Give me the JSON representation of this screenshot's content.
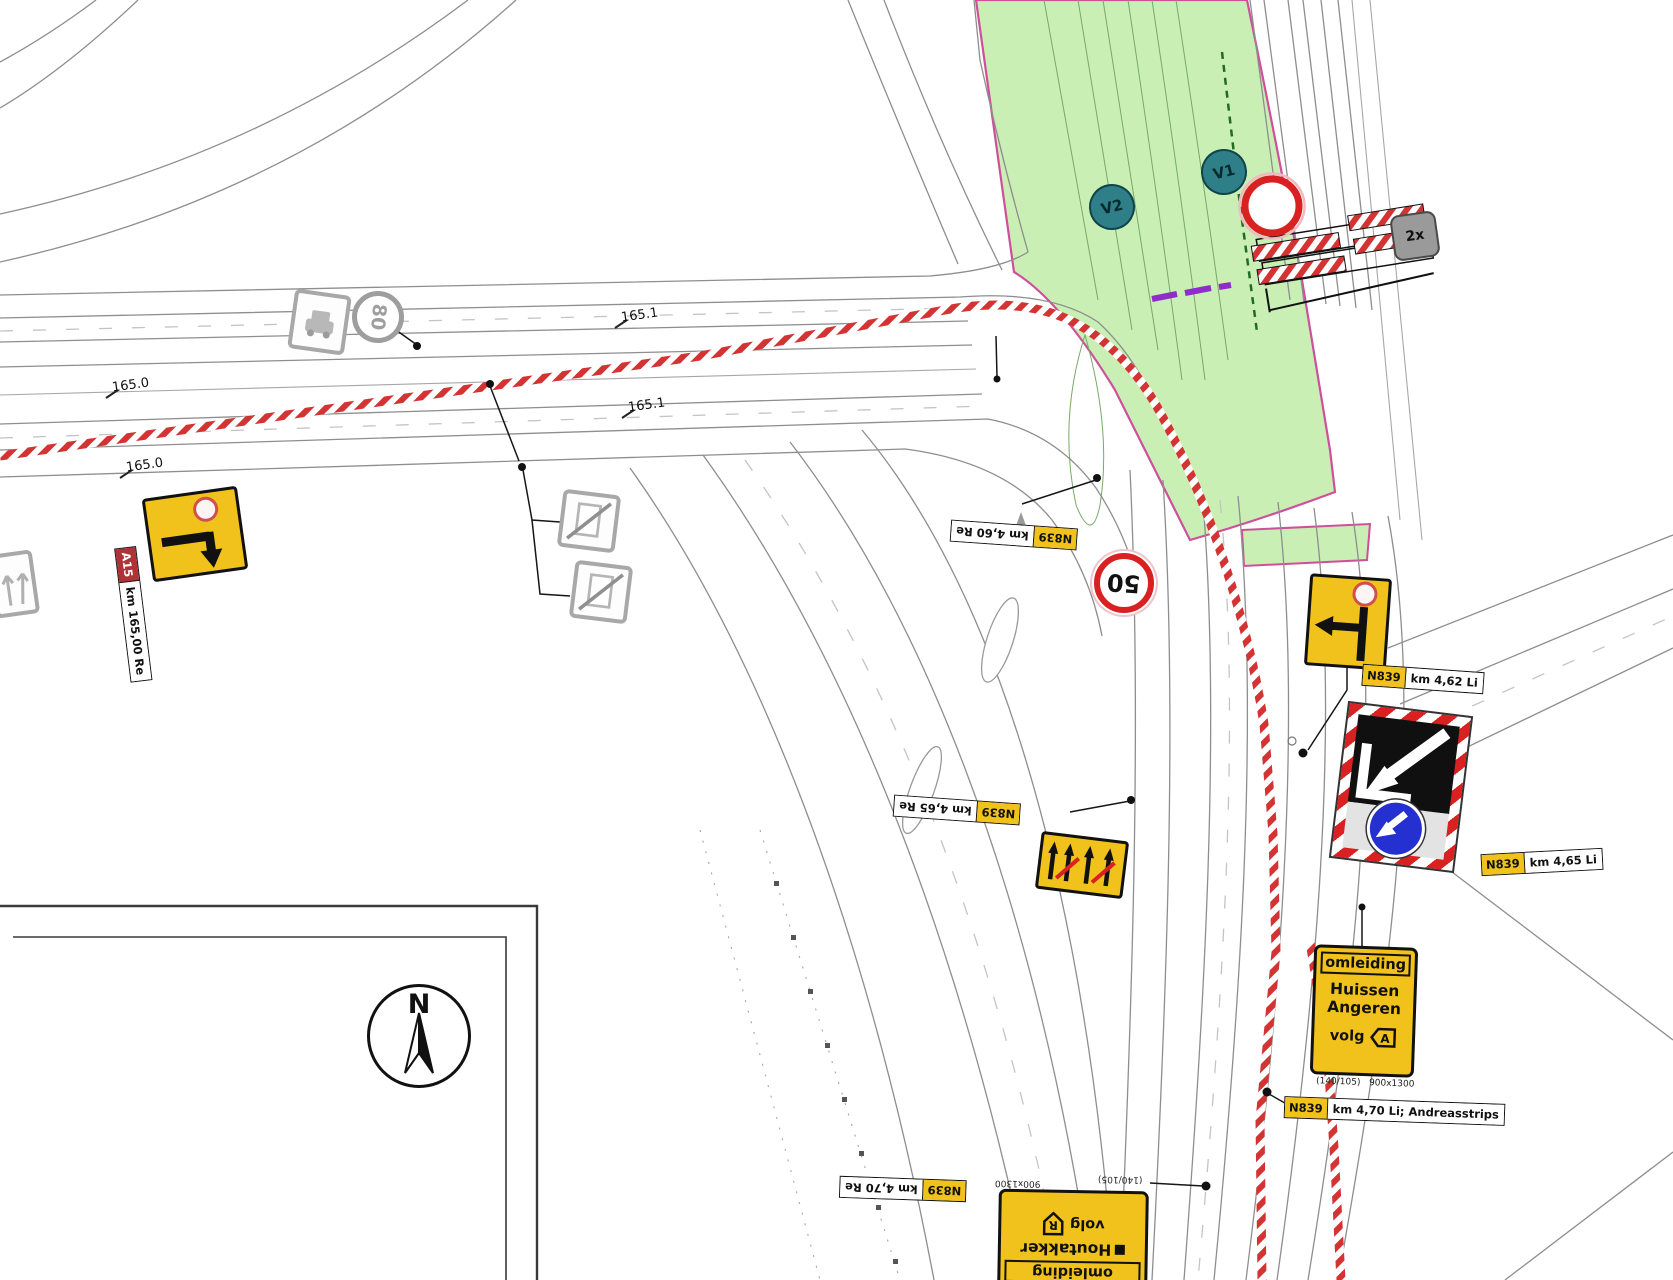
{
  "colors": {
    "work_zone_green": "#c9efb5",
    "zone_border": "#cf4f9b",
    "sign_yellow": "#f2c21c",
    "barrier_red": "#d92121",
    "detour_blue": "#2430cf",
    "purple_marker": "#8e2ccc"
  },
  "compass": {
    "letter": "N"
  },
  "barrier_tag": {
    "count": "2x"
  },
  "speed_signs": {
    "existing_80": "80",
    "temporary_50": "50"
  },
  "phase_badges": {
    "v1": "V1",
    "v2": "V2"
  },
  "km_markers": [
    "165.0",
    "165.0",
    "165.1",
    "165.1"
  ],
  "chips": {
    "a15": {
      "road": "A15",
      "km": "km 165,00 Re"
    },
    "n839_460re": {
      "road": "N839",
      "km": "km 4,60 Re"
    },
    "n839_462li": {
      "road": "N839",
      "km": "km 4,62 Li"
    },
    "n839_465li": {
      "road": "N839",
      "km": "km 4,65 Li"
    },
    "n839_465re": {
      "road": "N839",
      "km": "km 4,65 Re"
    },
    "n839_470re": {
      "road": "N839",
      "km": "km 4,70 Re"
    },
    "n839_470li": {
      "road": "N839",
      "km": "km 4,70 Li; Andreasstrips"
    }
  },
  "detour_signs": {
    "huissen": {
      "header": "omleiding",
      "dest1": "Huissen",
      "dest2": "Angeren",
      "follow": "volg",
      "code": "A",
      "print_left": "(140/105)",
      "print_right": "900x1300"
    },
    "houtakker": {
      "header": "omleiding",
      "dest1": "Houtakker",
      "follow": "volg",
      "code": "R",
      "print_left": "900x1300",
      "print_right": "(140/105)"
    }
  }
}
